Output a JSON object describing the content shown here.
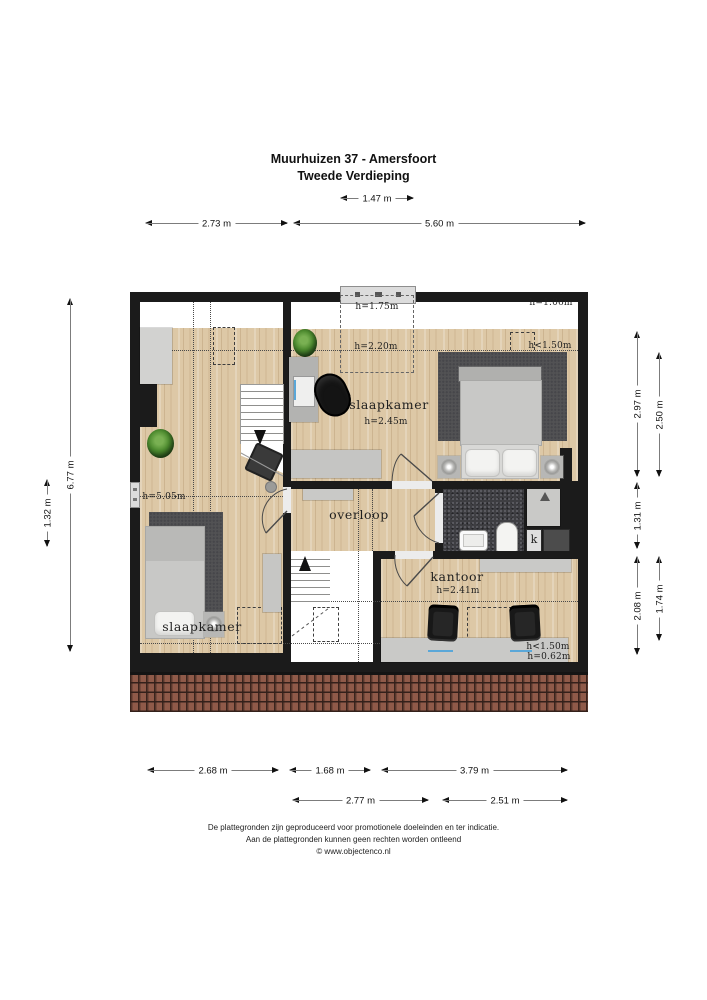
{
  "title": {
    "line1": "Muurhuizen 37 - Amersfoort",
    "line2": "Tweede Verdieping"
  },
  "rooms": {
    "left_bedroom": {
      "name": "slaapkamer",
      "height": "h=5.05m"
    },
    "right_bedroom": {
      "name": "slaapkamer",
      "height": "h=2.45m"
    },
    "landing": {
      "name": "overloop"
    },
    "office": {
      "name": "kantoor",
      "height": "h=2.41m"
    }
  },
  "annotations": {
    "h175": "h=1.75m",
    "h220": "h=2.20m",
    "h106": "h=1.06m",
    "h150_bedroom": "h<1.50m",
    "h150_office": "h<1.50m",
    "h062": "h=0.62m",
    "closet": "k"
  },
  "dimensions": {
    "top": [
      "1.47 m",
      "2.73 m",
      "5.60 m"
    ],
    "left": [
      "6.77 m",
      "1.32 m"
    ],
    "right": [
      "2.97 m",
      "2.50 m",
      "1.31 m",
      "2.08 m",
      "1.74 m"
    ],
    "bottom": [
      "2.68 m",
      "1.68 m",
      "3.79 m",
      "2.77 m",
      "2.51 m"
    ]
  },
  "footer": {
    "line1": "De plattegronden zijn geproduceerd voor promotionele doeleinden en ter indicatie.",
    "line2": "Aan de plattegronden kunnen geen rechten worden ontleend",
    "line3": "© www.objectenco.nl"
  },
  "colors": {
    "wall": "#1b1b1b",
    "wood_floor": "#ddc8a6",
    "low_headroom_zone": "#ffffff",
    "rug": "#525254",
    "bathroom_tile": "#3e3e42",
    "roof_tile": "#8f5a49",
    "furniture_gray": "#c9c9c7",
    "accent_blue": "#5aa7d8",
    "plant_green": "#4c8a2e"
  }
}
